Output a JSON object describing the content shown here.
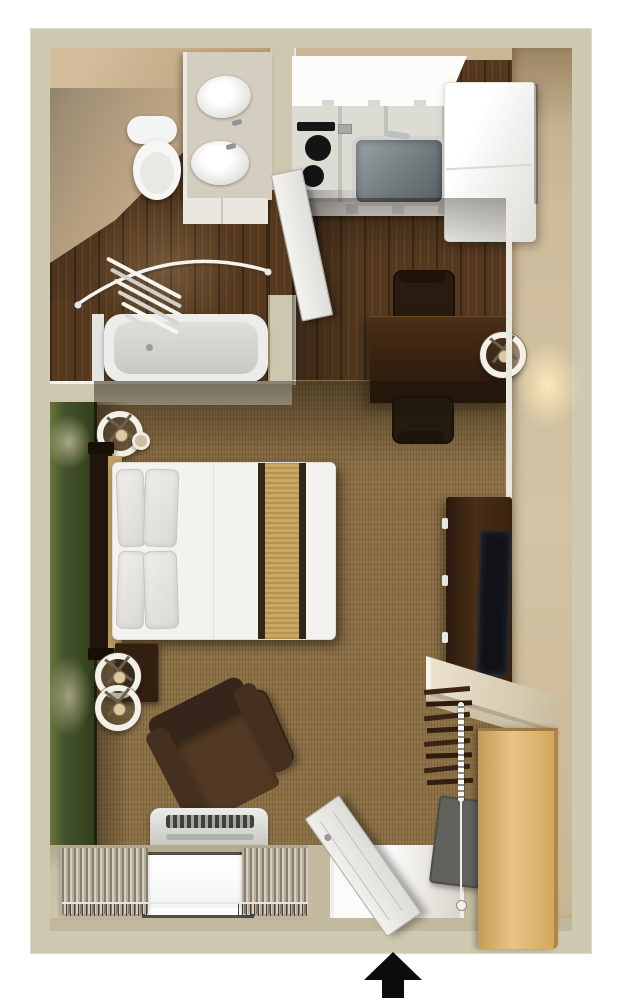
{
  "image_type": "3d-rendered-studio-apartment-floor-plan",
  "visible_text": [],
  "palette": {
    "page_background": "#ffffff",
    "outer_wall_sage": "#cecab1",
    "interior_wall_tan": "#cdbb9c",
    "wood_floor_walnut": "#54391f",
    "carpet_brown": "#8b7046",
    "accent_wall_green": "#42502a",
    "bed_linen_white": "#f3f2ee",
    "bed_runner_tan": "#c9a863",
    "dark_wood_furniture": "#3a2517",
    "armchair_brown": "#46301e",
    "kitchen_counter_grey": "#dcdbd4",
    "appliance_white": "#f7f7f5",
    "sink_stainless": "#7d868a",
    "closet_oak": "#ddb271",
    "entrance_arrow_black": "#0c0c0c"
  },
  "rooms": [
    {
      "name": "bathroom",
      "position": "top-left"
    },
    {
      "name": "kitchen",
      "position": "top-right"
    },
    {
      "name": "living-sleeping-area",
      "position": "center"
    },
    {
      "name": "entry",
      "position": "bottom-center"
    }
  ],
  "furniture_and_fixtures": [
    "bathroom-vanity-with-two-sinks",
    "toilet",
    "bathtub",
    "curved-shower-rod",
    "shower-curtain",
    "bathroom-door",
    "kitchen-upper-cabinets",
    "kitchen-counter",
    "cooktop-with-two-burners",
    "stainless-sink",
    "refrigerator",
    "dining-table",
    "two-dining-chairs",
    "table-lamp",
    "double-bed",
    "headboard",
    "four-pillows",
    "bed-runner",
    "nightstand",
    "three-drum-lamps",
    "armchair",
    "ottoman",
    "air-conditioner-unit",
    "window-with-curtains",
    "tv-console",
    "television",
    "wall-shelf",
    "clothes-hangers",
    "closet-oak-panel",
    "hanging-bead-chain",
    "entry-door",
    "luggage-rack"
  ],
  "entrance_arrow": {
    "direction": "up",
    "position": "bottom-center"
  }
}
